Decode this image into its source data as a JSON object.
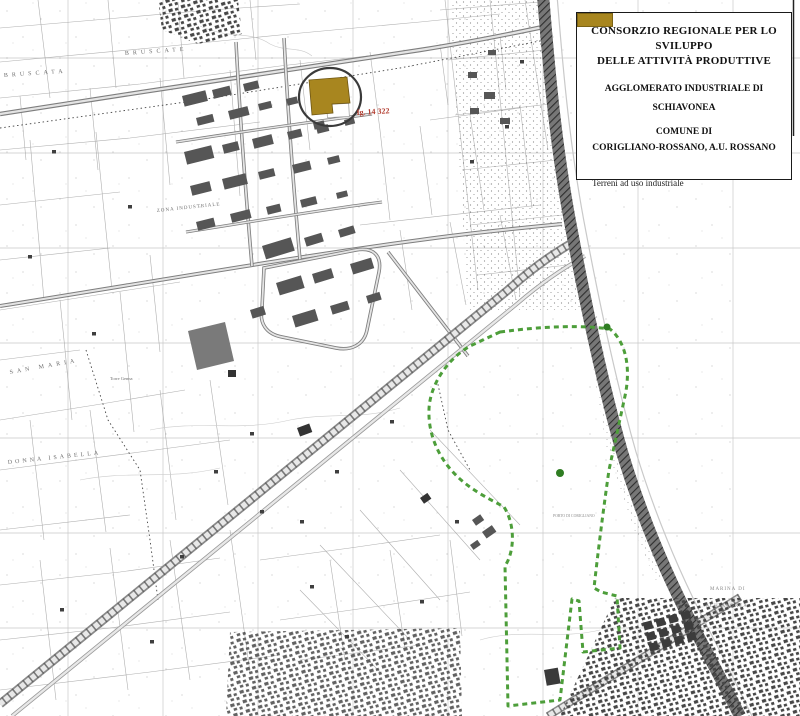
{
  "title_box": {
    "title_line1": "CONSORZIO REGIONALE PER LO SVILUPPO",
    "title_line2": "DELLE ATTIVITÀ PRODUTTIVE",
    "subtitle_line1": "AGGLOMERATO INDUSTRIALE DI",
    "subtitle_line2": "SCHIAVONEA",
    "commune_line1": "COMUNE DI",
    "commune_line2": "CORIGLIANO-ROSSANO, A.U. ROSSANO",
    "legend": {
      "label": "Terreni ad uso industriale"
    }
  },
  "colors": {
    "industrial_parcel": "#A8861F",
    "industrial_parcel_border": "#7C6315",
    "port_boundary_green": "#4D9E3A",
    "parcel_ref_red": "#B23B2E"
  },
  "map": {
    "parcel_ref": "fg. 14 322",
    "labels": {
      "bruscate": "BRUSCATE",
      "bruscata": "BRUSCATA",
      "zona_industriale": "ZONA INDUSTRIALE",
      "san_maria": "SAN MARIA",
      "torre_genna": "Torre Genna",
      "donna_isabella": "DONNA ISABELLA",
      "porto": "PORTO DI CORIGLIANO",
      "marina_line1": "MARINA DI",
      "marina_line2": "SCHIAVONEA"
    }
  }
}
